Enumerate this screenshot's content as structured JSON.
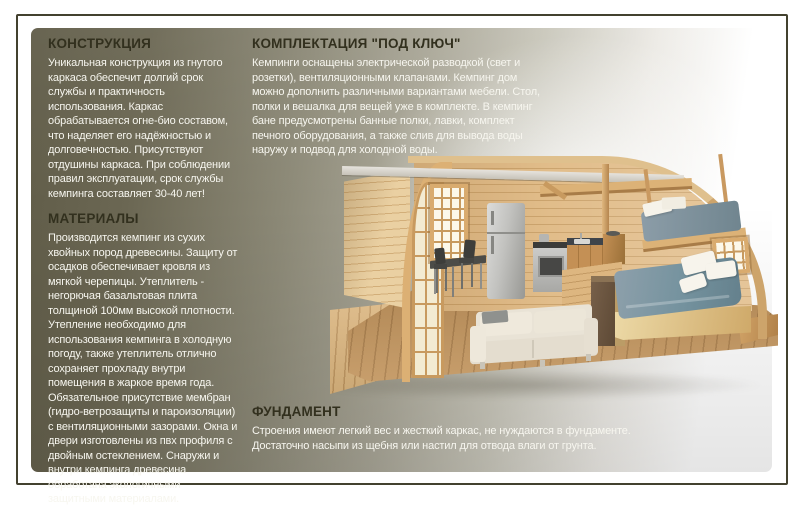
{
  "colors": {
    "panel_dark": "#605c48",
    "panel_mid": "#979482",
    "panel_light": "#ffffff",
    "frame": "#43412f",
    "heading_text": "#32301e",
    "body_text": "#f7f6ef",
    "wood": "#d2a468",
    "bed_fabric": "#74929e"
  },
  "sections": {
    "construction": {
      "title": "КОНСТРУКЦИЯ",
      "body": "Уникальная конструкция из гнутого каркаса обеспечит долгий срок службы и практичность использования. Каркас обрабатывается огне-био составом, что наделяет его надёжностью и долговечностью. Присутствуют отдушины каркаса. При соблюдении правил эксплуатации, срок службы кемпинга составляет 30-40 лет!"
    },
    "materials": {
      "title": "МАТЕРИАЛЫ",
      "body": "Производится кемпинг из сухих хвойных пород древесины. Защиту от осадков обеспечивает кровля из мягкой черепицы. Утеплитель - негорючая базальтовая плита толщиной 100мм высокой плотности. Утепление необходимо для использования кемпинга в холодную погоду, также утеплитель отлично сохраняет прохладу внутри помещения в жаркое время года. Обязательное присутствие мембран (гидро-ветрозащиты и пароизоляции) с вентиляционными зазорами. Окна и двери изготовлены из пвх профиля с двойным остеклением. Снаружи и внутри кемпинга древесина обработана экологичными  защитными материалами."
    },
    "turnkey": {
      "title": "КОМПЛЕКТАЦИЯ \"ПОД КЛЮЧ\"",
      "body": "Кемпинги оснащены электрической разводкой (свет и розетки), вентиляционными клапанами. Кемпинг дом можно дополнить различными вариантами мебели. Стол, полки и вешалка для вещей уже в комплекте. В кемпинг бане предусмотрены банные полки, лавки, комплект печного оборудования, а также слив для вывода воды наружу и подвод для холодной воды."
    },
    "foundation": {
      "title": "ФУНДАМЕНТ",
      "body": "Строения имеют легкий вес и жесткий каркас, не нуждаются в фундаменте. Достаточно насыпи из щебня или настил для отвода влаги от грунта."
    }
  },
  "illustration": {
    "name": "camping-house-cutaway-3d"
  }
}
